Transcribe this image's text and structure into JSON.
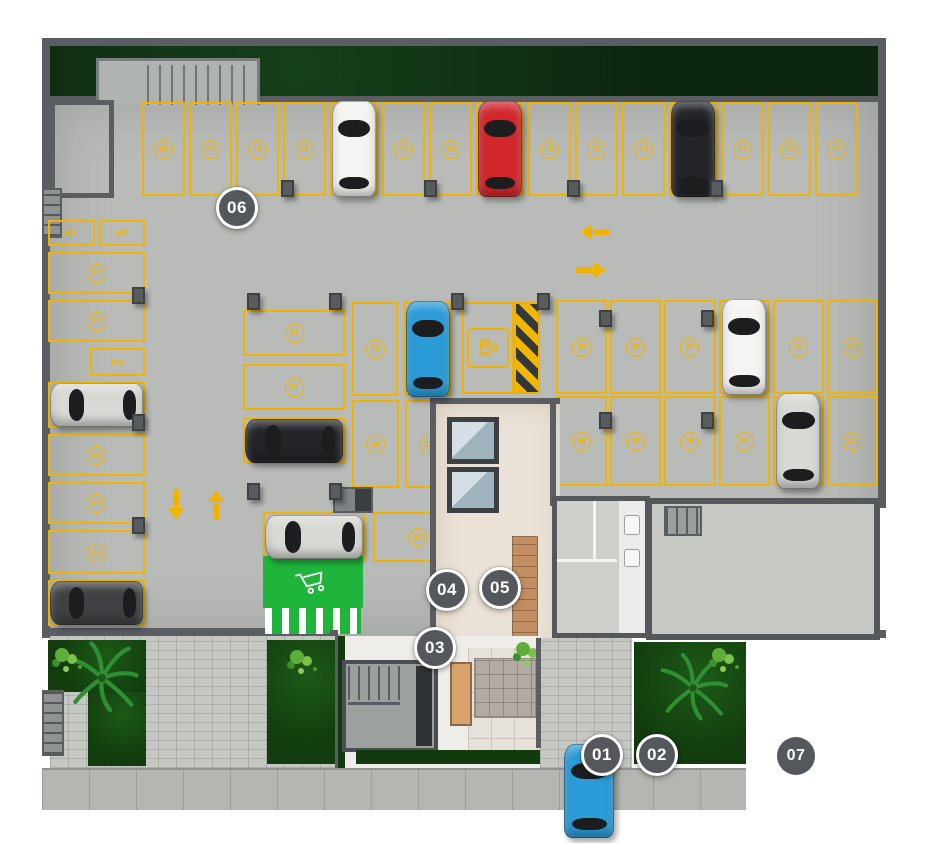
{
  "colors": {
    "line": "#f0b400",
    "marker": "#54585c",
    "cart_zone": "#1fb53c",
    "garden": "#16420f",
    "grass": "#0d260f",
    "cars": {
      "white": "#f4f4f2",
      "red": "#d2262c",
      "black": "#232428",
      "silver": "#d8d9d5",
      "blue": "#2b9cd8",
      "darkgray": "#3f4144"
    }
  },
  "markers": [
    {
      "id": "01",
      "label": "01"
    },
    {
      "id": "02",
      "label": "02"
    },
    {
      "id": "03",
      "label": "03"
    },
    {
      "id": "04",
      "label": "04"
    },
    {
      "id": "05",
      "label": "05"
    },
    {
      "id": "06",
      "label": "06"
    },
    {
      "id": "07",
      "label": "07"
    }
  ],
  "moto": {
    "m1": "M1",
    "m2": "M2",
    "m3": "M3"
  },
  "arrows": {
    "left": "left",
    "right": "right",
    "down": "down",
    "up": "up"
  },
  "icons": {
    "ev": "ev-charging-station",
    "cart": "shopping-cart",
    "palm": "palm-tree"
  },
  "parking": {
    "top_row": [
      {
        "num": "08"
      },
      {
        "num": "09"
      },
      {
        "num": "10"
      },
      {
        "num": "11"
      },
      {
        "car": "white"
      },
      {
        "num": "13"
      },
      {
        "num": "14"
      },
      {
        "car": "red"
      },
      {
        "num": "16"
      },
      {
        "num": "17"
      },
      {
        "num": "18"
      },
      {
        "car": "black"
      },
      {
        "num": "20"
      },
      {
        "num": "21"
      },
      {
        "num": "22"
      }
    ],
    "left_column": [
      {
        "num": "01"
      },
      {
        "num": "02"
      },
      {
        "car": "silver"
      },
      {
        "num": "04"
      },
      {
        "num": "05"
      },
      {
        "num": "06"
      },
      {
        "car": "darkgray"
      }
    ],
    "mid_stack": [
      {
        "num": "31"
      },
      {
        "num": "32"
      },
      {
        "car": "black"
      }
    ],
    "mid_bottom": [
      {
        "car": "silver"
      },
      {
        "num": "43"
      }
    ],
    "mid_vert_top": [
      {
        "num": "23"
      },
      {
        "car": "blue"
      }
    ],
    "mid_vert_bottom": [
      {
        "num": "34"
      },
      {
        "num": "35"
      }
    ],
    "right_top": [
      {
        "num": "25"
      },
      {
        "num": "26"
      },
      {
        "num": "27"
      },
      {
        "car": "white"
      },
      {
        "num": "29"
      },
      {
        "num": "30"
      }
    ],
    "right_bottom": [
      {
        "num": "36"
      },
      {
        "num": "37"
      },
      {
        "num": "38"
      },
      {
        "num": "39"
      },
      {
        "car": "silver"
      },
      {
        "num": "41"
      }
    ]
  }
}
